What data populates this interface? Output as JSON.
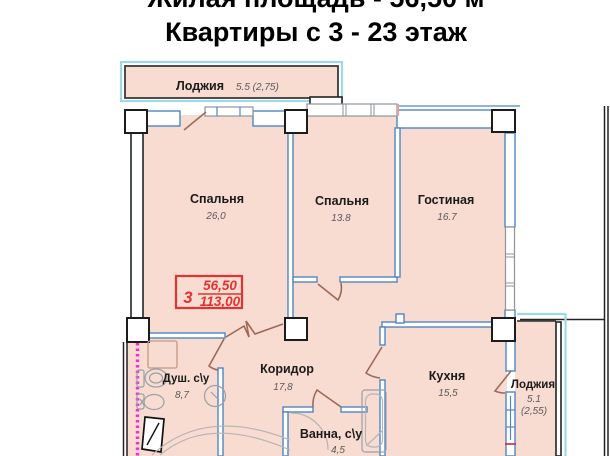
{
  "title": {
    "line1": "Жилая площадь - 56,50 м",
    "line2": "Квартиры с 3 - 23 этаж"
  },
  "stamp": {
    "rooms_count": "3",
    "living_area": "56,50",
    "total_area": "113,00"
  },
  "rooms": {
    "loggia_top": {
      "name": "Лоджия",
      "area": "5.5 (2,75)"
    },
    "bedroom_large": {
      "name": "Спальня",
      "area": "26,0"
    },
    "bedroom_small": {
      "name": "Спальня",
      "area": "13.8"
    },
    "living": {
      "name": "Гостиная",
      "area": "16.7"
    },
    "corridor": {
      "name": "Коридор",
      "area": "17,8"
    },
    "shower_wc": {
      "name": "Душ. c\\у",
      "area": "8,7"
    },
    "bath_wc": {
      "name": "Ванна, c\\у",
      "area": "4,5"
    },
    "kitchen": {
      "name": "Кухня",
      "area": "15,5"
    },
    "loggia_right": {
      "name": "Лоджия",
      "area": "5.1",
      "area_alt": "(2,55)"
    }
  },
  "colors": {
    "room_fill": "#f8dbd1",
    "wall_blue": "#4f86c6",
    "loggia_cyan": "#9fd8ec",
    "window_gray": "#8e959c",
    "door_brown": "#9d6a58",
    "stamp_red": "#e23333",
    "section_magenta": "#ee2fd2",
    "text_dark": "#1b1b1b",
    "value_gray": "#5a5a5a"
  }
}
